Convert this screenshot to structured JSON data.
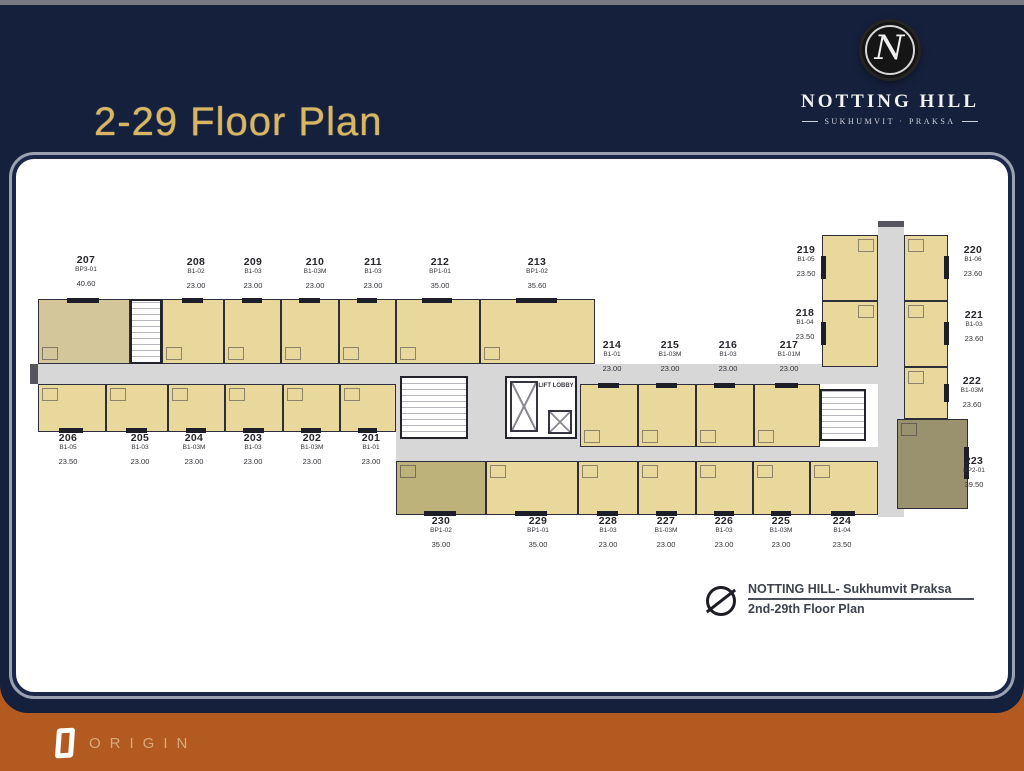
{
  "colors": {
    "navy": "#15203c",
    "gold": "#d8b662",
    "orange": "#b25a1f",
    "corridor": "#d7d7d8",
    "unit_yellow": "#e9d89c",
    "unit_khaki": "#d2c69a",
    "unit_olive": "#beb27b",
    "unit_dark": "#9a926e",
    "wall": "#2e2e3a"
  },
  "slide": {
    "title": "2-29 Floor Plan"
  },
  "brand": {
    "monogram": "N",
    "name": "NOTTING HILL",
    "tagline": "SUKHUMVIT · PRAKSA"
  },
  "footer": {
    "brand": "ORIGIN"
  },
  "plan": {
    "lift_label": "LIFT LOBBY",
    "annotation_title": "NOTTING HILL- Sukhumvit Praksa",
    "annotation_subtitle": "2nd-29th Floor Plan",
    "units": [
      {
        "no": "201",
        "type": "B1-01",
        "area": "23.00"
      },
      {
        "no": "202",
        "type": "B1-03M",
        "area": "23.00"
      },
      {
        "no": "203",
        "type": "B1-03",
        "area": "23.00"
      },
      {
        "no": "204",
        "type": "B1-03M",
        "area": "23.00"
      },
      {
        "no": "205",
        "type": "B1-03",
        "area": "23.00"
      },
      {
        "no": "206",
        "type": "B1-05",
        "area": "23.50"
      },
      {
        "no": "207",
        "type": "BP3-01",
        "area": "40.60"
      },
      {
        "no": "208",
        "type": "B1-02",
        "area": "23.00"
      },
      {
        "no": "209",
        "type": "B1-03",
        "area": "23.00"
      },
      {
        "no": "210",
        "type": "B1-03M",
        "area": "23.00"
      },
      {
        "no": "211",
        "type": "B1-03",
        "area": "23.00"
      },
      {
        "no": "212",
        "type": "BP1-01",
        "area": "35.00"
      },
      {
        "no": "213",
        "type": "BP1-02",
        "area": "35.60"
      },
      {
        "no": "214",
        "type": "B1-01",
        "area": "23.00"
      },
      {
        "no": "215",
        "type": "B1-03M",
        "area": "23.00"
      },
      {
        "no": "216",
        "type": "B1-03",
        "area": "23.00"
      },
      {
        "no": "217",
        "type": "B1-01M",
        "area": "23.00"
      },
      {
        "no": "218",
        "type": "B1-04",
        "area": "23.50"
      },
      {
        "no": "219",
        "type": "B1-05",
        "area": "23.50"
      },
      {
        "no": "220",
        "type": "B1-06",
        "area": "23.60"
      },
      {
        "no": "221",
        "type": "B1-03",
        "area": "23.60"
      },
      {
        "no": "222",
        "type": "B1-03M",
        "area": "23.60"
      },
      {
        "no": "223",
        "type": "BP2-01",
        "area": "39.50"
      },
      {
        "no": "224",
        "type": "B1-04",
        "area": "23.50"
      },
      {
        "no": "225",
        "type": "B1-03M",
        "area": "23.00"
      },
      {
        "no": "226",
        "type": "B1-03",
        "area": "23.00"
      },
      {
        "no": "227",
        "type": "B1-03M",
        "area": "23.00"
      },
      {
        "no": "228",
        "type": "B1-03",
        "area": "23.00"
      },
      {
        "no": "229",
        "type": "BP1-01",
        "area": "35.00"
      },
      {
        "no": "230",
        "type": "BP1-02",
        "area": "35.00"
      }
    ]
  }
}
